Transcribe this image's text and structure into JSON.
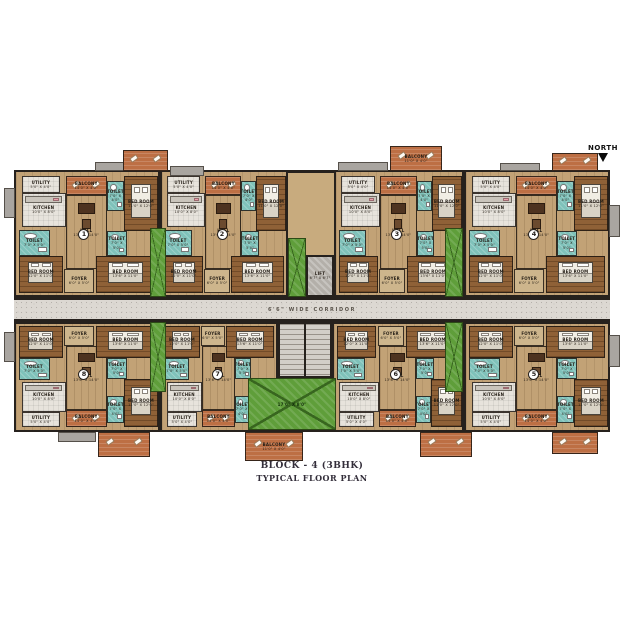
{
  "title": {
    "line1": "BLOCK - 4 (3BHK)",
    "line2": "TYPICAL FLOOR PLAN"
  },
  "north": {
    "label": "NORTH"
  },
  "corridor": {
    "label": "6'6\" WIDE CORRIDOR"
  },
  "core": {
    "lift": {
      "label": "LIFT",
      "dims": "6'7\" X 6'7\""
    },
    "plaza": {
      "dims": "17'0\" X 8'0\""
    }
  },
  "colors": {
    "wall": "#26211d",
    "balcony_orange": "#bd6f44",
    "bedroom_wood": "#8f6137",
    "hall_tan": "#c2a276",
    "kitchen_white": "#e7e3dc",
    "toilet_teal": "#7fc2ba",
    "duct_green": "#5f9e3a",
    "corridor_floor": "#dcd8d2",
    "lift_gray": "#b3afa9"
  },
  "rooms": [
    {
      "key": "utility",
      "label": "UTILITY",
      "dims": "5'0\" X 4'0\"",
      "type": "kitchen",
      "rect": [
        4,
        3,
        27,
        14
      ]
    },
    {
      "key": "kitchen",
      "label": "KITCHEN",
      "dims": "10'0\" X 8'0\"",
      "type": "kitchen",
      "rect": [
        4,
        17,
        31,
        28
      ],
      "furn": "counter"
    },
    {
      "key": "balcony",
      "label": "BALCONY",
      "dims": "14'0\" X 4'0\"",
      "type": "balcony",
      "rect": [
        35,
        3,
        29,
        16
      ],
      "furn": "recliner"
    },
    {
      "key": "toilet-1",
      "label": "TOILET",
      "dims": "7'0\" X 4'0\"",
      "type": "toilet",
      "rect": [
        64,
        7,
        12,
        25
      ],
      "furn": "wc"
    },
    {
      "key": "bed-1",
      "label": "BED ROOM",
      "dims": "11'0\" X 12'0\"",
      "type": "bedroom",
      "rect": [
        76,
        3,
        24,
        45
      ],
      "furn": "bed"
    },
    {
      "key": "toilet-2",
      "label": "TOILET",
      "dims": "7'0\" X 5'0\"",
      "type": "toilet",
      "rect": [
        2,
        47,
        22,
        21
      ],
      "furn": "wc"
    },
    {
      "key": "hall",
      "label": "HALL",
      "dims": "13'6\" X 14'0\"",
      "type": "hall",
      "rect": [
        35,
        19,
        29,
        60
      ],
      "furn": "sofa"
    },
    {
      "key": "toilet-3",
      "label": "TOILET",
      "dims": "7'0\" X 5'0\"",
      "type": "toilet",
      "rect": [
        64,
        48,
        14,
        20
      ],
      "furn": "wc"
    },
    {
      "key": "bed-2",
      "label": "BED ROOM",
      "dims": "12'0\" X 11'0\"",
      "type": "bedroom",
      "rect": [
        2,
        68,
        31,
        30
      ],
      "furn": "bed"
    },
    {
      "key": "foyer",
      "label": "FOYER",
      "dims": "6'0\" X 5'0\"",
      "type": "hall2",
      "rect": [
        34,
        79,
        21,
        19
      ]
    },
    {
      "key": "bed-3",
      "label": "BED ROOM",
      "dims": "13'6\" X 11'0\"",
      "type": "bedroom",
      "rect": [
        56,
        68,
        42,
        30
      ],
      "furn": "bed"
    }
  ],
  "layout": {
    "rows": [
      {
        "name": "top",
        "y": 170,
        "h": 127,
        "flip": false,
        "units": [
          {
            "number": "1",
            "x": 14,
            "w": 146
          },
          {
            "number": "2",
            "x": 160,
            "w": 128
          },
          {
            "number": "3",
            "x": 334,
            "w": 130
          },
          {
            "number": "4",
            "x": 464,
            "w": 146
          }
        ]
      },
      {
        "name": "bottom",
        "y": 322,
        "h": 110,
        "flip": true,
        "units": [
          {
            "number": "8",
            "x": 14,
            "w": 146
          },
          {
            "number": "7",
            "x": 160,
            "w": 118
          },
          {
            "number": "6",
            "x": 332,
            "w": 132
          },
          {
            "number": "5",
            "x": 464,
            "w": 146
          }
        ]
      }
    ],
    "ducts": [
      [
        150,
        228,
        16,
        69
      ],
      [
        288,
        238,
        18,
        59
      ],
      [
        445,
        228,
        18,
        69
      ],
      [
        150,
        322,
        16,
        70
      ],
      [
        445,
        322,
        18,
        70
      ]
    ],
    "plaza": [
      248,
      378,
      88,
      52
    ],
    "lift": [
      306,
      255,
      28,
      42
    ],
    "stairs": [
      278,
      322,
      54,
      56
    ],
    "balconies_out": [
      {
        "r": [
          123,
          150,
          45,
          21
        ]
      },
      {
        "r": [
          390,
          146,
          52,
          25
        ],
        "label": "BALCONY",
        "dims": "11'0\" X 4'0\""
      },
      {
        "r": [
          552,
          153,
          46,
          18
        ]
      },
      {
        "r": [
          98,
          432,
          52,
          25
        ]
      },
      {
        "r": [
          245,
          432,
          58,
          29
        ],
        "label": "BALCONY",
        "dims": "11'0\" X 4'0\""
      },
      {
        "r": [
          420,
          432,
          52,
          25
        ]
      },
      {
        "r": [
          552,
          432,
          46,
          22
        ]
      }
    ],
    "ledges": [
      [
        95,
        162,
        52,
        9
      ],
      [
        338,
        162,
        50,
        9
      ],
      [
        170,
        166,
        34,
        10
      ],
      [
        4,
        188,
        11,
        30
      ],
      [
        4,
        332,
        11,
        30
      ],
      [
        609,
        205,
        11,
        32
      ],
      [
        609,
        335,
        11,
        32
      ],
      [
        58,
        432,
        38,
        10
      ],
      [
        500,
        163,
        40,
        8
      ]
    ]
  }
}
